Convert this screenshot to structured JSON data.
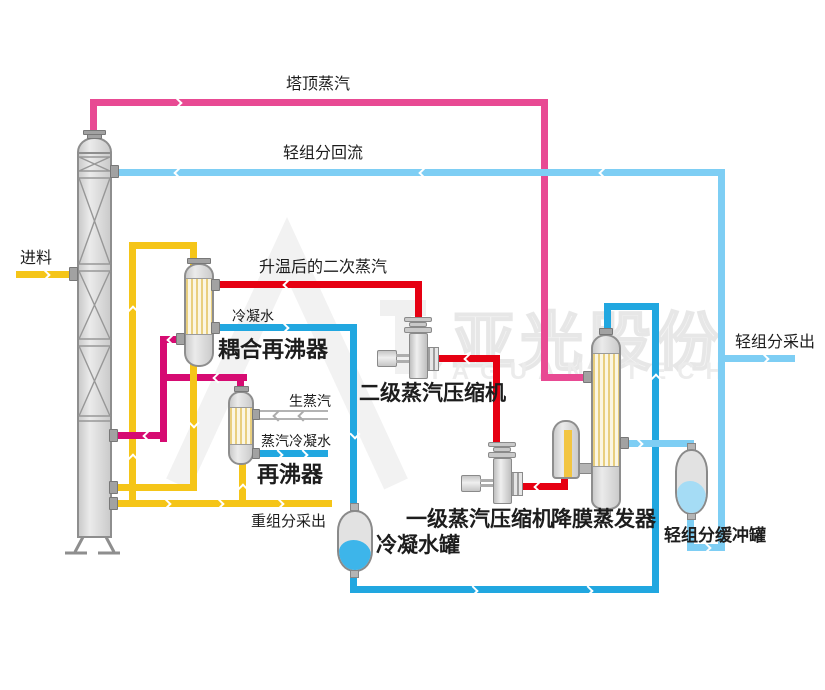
{
  "diagram": {
    "type": "process-flow",
    "system": "MVR distillation / evaporation unit"
  },
  "labels": {
    "tower_top_steam": "塔顶蒸汽",
    "light_component_reflux": "轻组分回流",
    "feed": "进料",
    "heated_secondary_steam": "升温后的二次蒸汽",
    "condensate_water": "冷凝水",
    "coupled_reboiler": "耦合再沸器",
    "raw_steam": "生蒸汽",
    "steam_condensate": "蒸汽冷凝水",
    "reboiler": "再沸器",
    "secondary_steam_compressor": "二级蒸汽压缩机",
    "primary_steam_compressor": "一级蒸汽压缩机",
    "falling_film_evaporator": "降膜蒸发器",
    "condensate_tank": "冷凝水罐",
    "heavy_component_draw": "重组分采出",
    "light_component_draw": "轻组分采出",
    "light_component_buffer_tank": "轻组分缓冲罐"
  },
  "watermark": {
    "cn": "亚光股份",
    "en": "YAGUANGTECH"
  },
  "colors": {
    "pink": "#e84a93",
    "magenta": "#d60b72",
    "red": "#e60012",
    "yellow": "#f5c518",
    "blue": "#21a7e0",
    "light_blue": "#7ecef4",
    "liquid_blue": "#3db5ea",
    "liquid_light_blue": "#a5dcf5"
  }
}
